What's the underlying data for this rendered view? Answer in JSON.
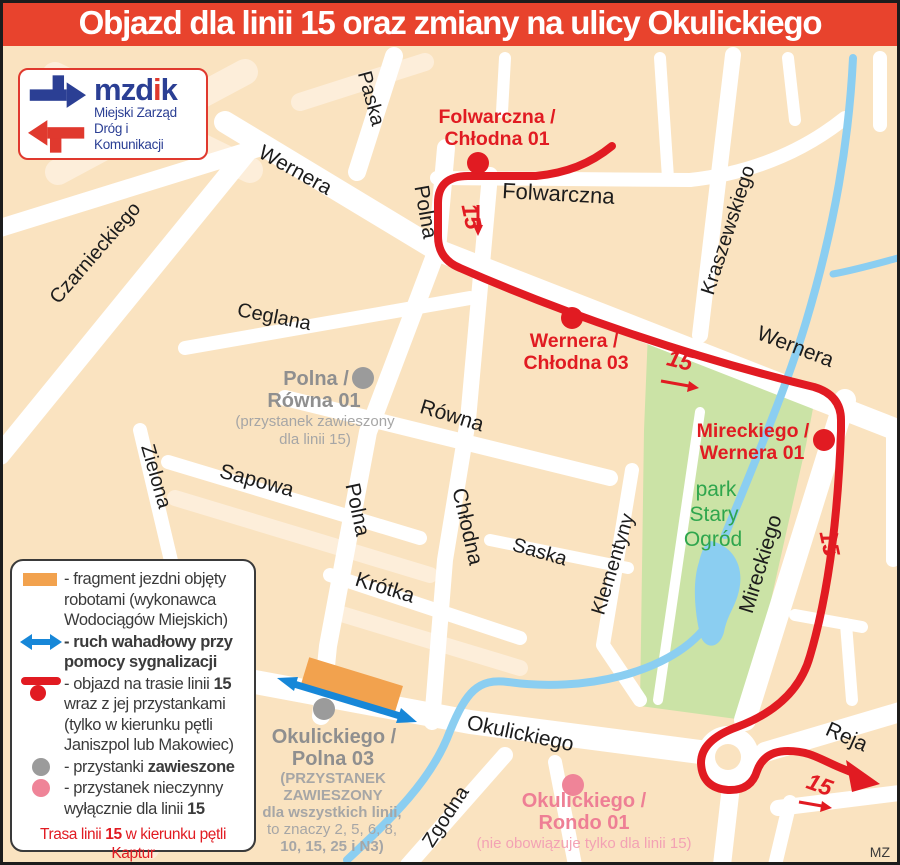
{
  "title": "Objazd dla linii 15 oraz zmiany na ulicy Okulickiego",
  "logo": {
    "word_part1": "mzd",
    "word_part2": "i",
    "word_part3": "k",
    "subtitle_line1": "Miejski Zarząd",
    "subtitle_line2": "Dróg i Komunikacji"
  },
  "streets": {
    "paska": "Paska",
    "wernera_nw": "Wernera",
    "wernera_e": "Wernera",
    "polna_n": "Polna",
    "polna_s": "Polna",
    "folwarczna": "Folwarczna",
    "czarnieckiego": "Czarnieckiego",
    "kraszewskiego": "Kraszewskiego",
    "ceglana": "Ceglana",
    "rowna": "Równa",
    "zielona": "Zielona",
    "sapowa": "Sapowa",
    "chlodna": "Chłodna",
    "saska": "Saska",
    "klementyny": "Klementyny",
    "krotka": "Krótka",
    "mireckiego": "Mireckiego",
    "okulickiego": "Okulickiego",
    "zgodna": "Zgodna",
    "reja": "Reja"
  },
  "park": {
    "line1": "park",
    "line2": "Stary",
    "line3": "Ogród"
  },
  "route": {
    "number": "15"
  },
  "stops": {
    "folwarczna_chlodna": {
      "line1": "Folwarczna /",
      "line2": "Chłodna 01"
    },
    "wernera_chlodna": {
      "line1": "Wernera /",
      "line2": "Chłodna 03"
    },
    "mireckiego_wernera": {
      "line1": "Mireckiego /",
      "line2": "Wernera 01"
    },
    "polna_rowna": {
      "line1": "Polna /",
      "line2": "Równa 01",
      "note1": "(przystanek zawieszony",
      "note2": "dla linii 15)"
    },
    "okulickiego_polna": {
      "line1": "Okulickiego /",
      "line2": "Polna 03",
      "note1": "(PRZYSTANEK",
      "note2": "ZAWIESZONY",
      "note3": "dla wszystkich linii,",
      "note4": "to znaczy 2, 5, 6, 8,",
      "note5": "10, 15, 25 i N3)"
    },
    "okulickiego_rondo": {
      "line1": "Okulickiego /",
      "line2": "Rondo 01",
      "note1": "(nie obowiązuje tylko dla linii 15)"
    }
  },
  "legend": {
    "roadworks_line1": "- fragment jezdni objęty",
    "roadworks_line2": "robotami (wykonawca",
    "roadworks_line3": "Wodociągów Miejskich)",
    "shuttle_line1": "- ruch wahadłowy przy",
    "shuttle_line2": "pomocy sygnalizacji",
    "detour_pre": "- objazd na trasie linii ",
    "detour_bold": "15",
    "detour_line2": "wraz z jej przystankami",
    "detour_line3": "(tylko w kierunku pętli",
    "detour_line4": "Janiszpol lub Makowiec)",
    "suspended_pre": "- przystanki ",
    "suspended_bold": "zawieszone",
    "closed_line1": "- przystanek nieczynny",
    "closed_pre": "wyłącznie dla linii ",
    "closed_bold": "15",
    "note_pre": "Trasa linii ",
    "note_bold": "15",
    "note_post": " w kierunku pętli Kaptur",
    "note_line2": "(przez ulicę Chłodną) nie zmienia się."
  },
  "credit": "MZ",
  "colors": {
    "banner_red": "#e8432d",
    "route_red": "#e11b22",
    "suspended_gray": "#9b9b9b",
    "closed_pink": "#ef8498",
    "roadworks_orange": "#f2a24e",
    "shuttle_blue": "#1787d8",
    "park_green": "#cbe3a6",
    "water_blue": "#8bcef1",
    "background_peach": "#fae3c0",
    "logo_blue": "#2b3f94"
  }
}
